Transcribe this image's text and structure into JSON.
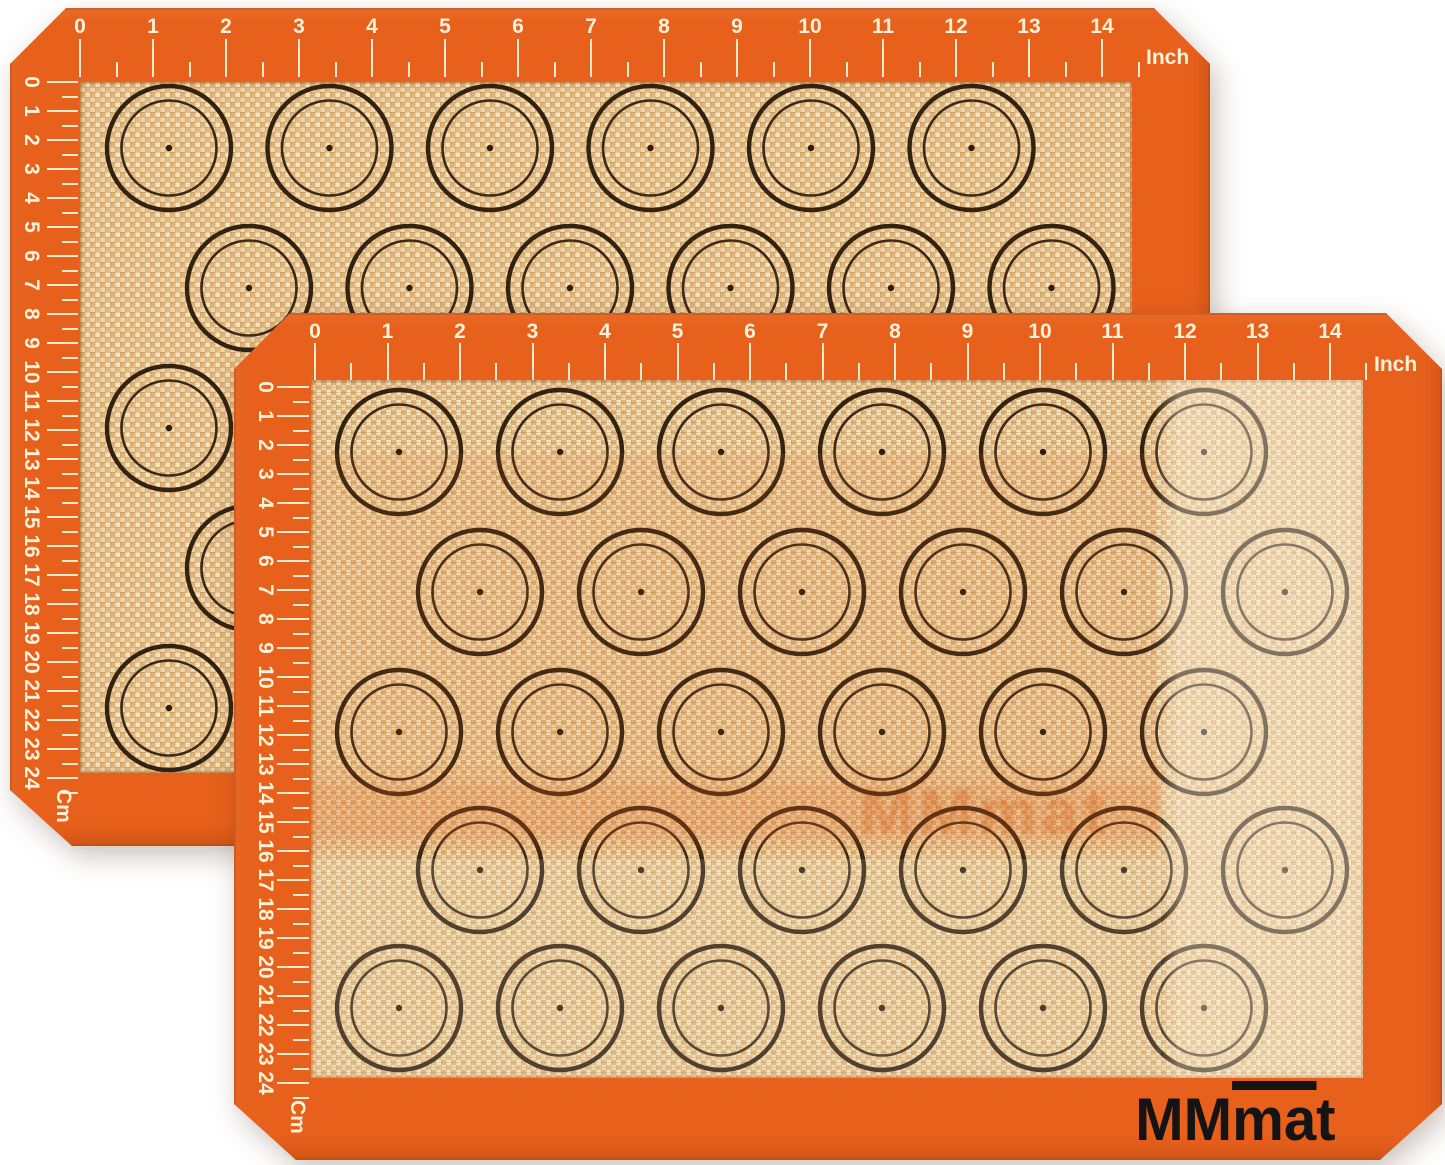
{
  "colors": {
    "page_bg": "#ffffff",
    "mat_orange": "#e7601c",
    "mat_orange_deep": "#d14e12",
    "weave_base": "#ecca96",
    "weave_light": "#f4e3bd",
    "weave_light2": "#efd6a9",
    "weave_tan": "#e2ba83",
    "weave_tan2": "#dfb278",
    "circle_ink": "#241507",
    "ruler_ink": "#fdf2da",
    "logo_ink": "#141414",
    "watermark_tint": "rgba(205,92,25,0.32)"
  },
  "rulers": {
    "inch_numbers": [
      "0",
      "1",
      "2",
      "3",
      "4",
      "5",
      "6",
      "7",
      "8",
      "9",
      "10",
      "11",
      "12",
      "13",
      "14"
    ],
    "cm_numbers": [
      "0",
      "1",
      "2",
      "3",
      "4",
      "5",
      "6",
      "7",
      "8",
      "9",
      "10",
      "11",
      "12",
      "13",
      "14",
      "15",
      "16",
      "17",
      "18",
      "19",
      "20",
      "21",
      "22",
      "23",
      "24"
    ],
    "inch_unit_label": "Inch",
    "cm_unit_label": "Cm"
  },
  "branding": {
    "logo_mm": "MM",
    "logo_ma": "ma",
    "logo_t": "t",
    "watermark_text": "MMmat"
  }
}
